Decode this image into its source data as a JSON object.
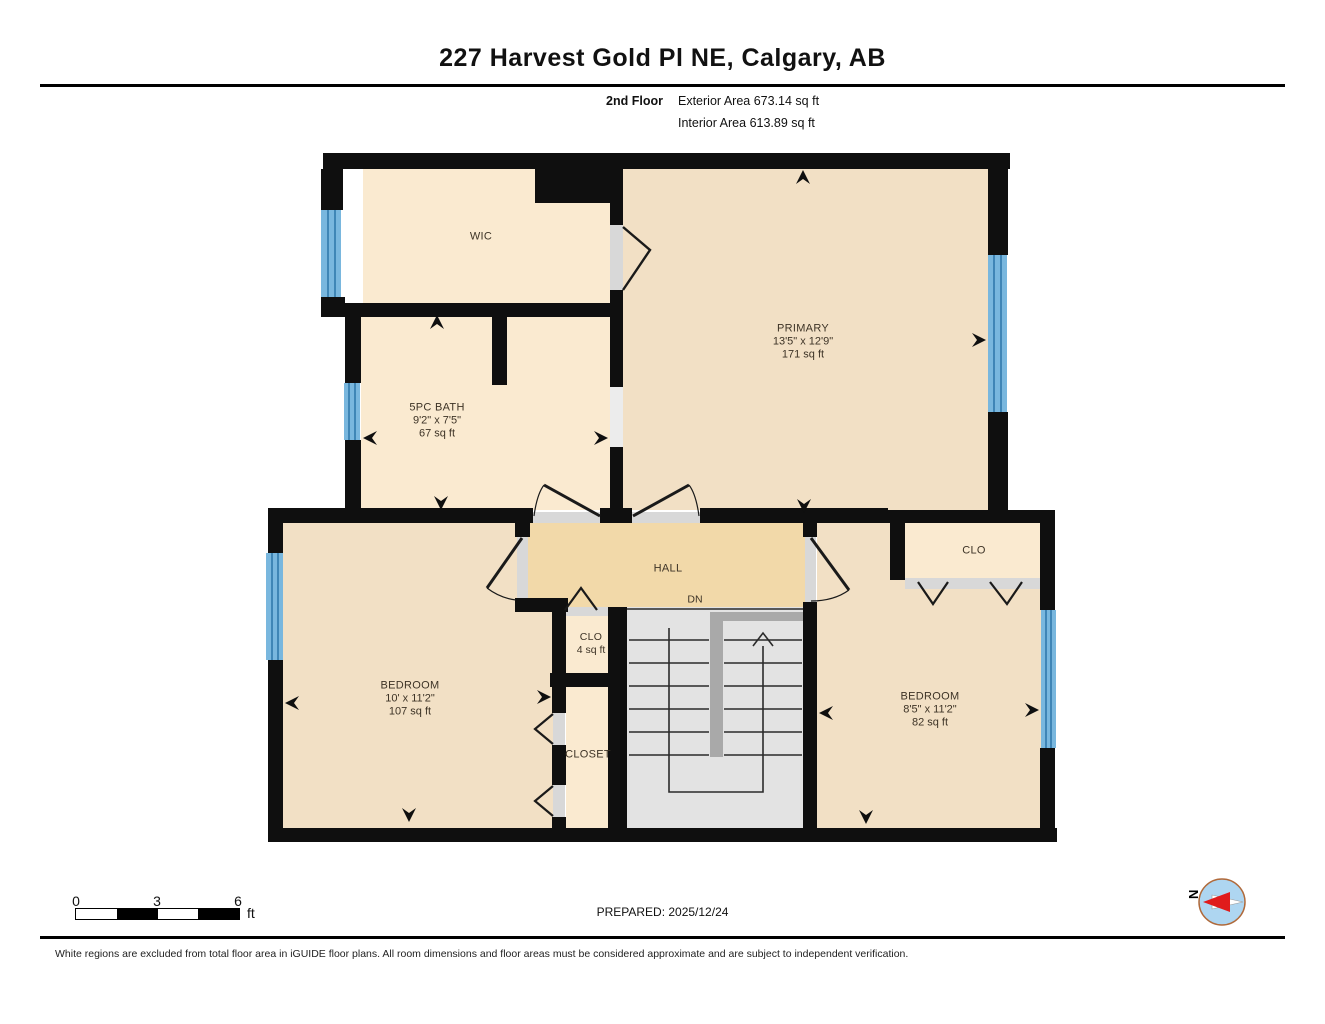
{
  "header": {
    "title": "227 Harvest Gold Pl NE, Calgary, AB",
    "floor_label": "2nd Floor",
    "exterior_area": "Exterior Area 673.14 sq ft",
    "interior_area": "Interior Area 613.89 sq ft"
  },
  "rooms": {
    "wic": {
      "name": "WIC"
    },
    "primary": {
      "name": "PRIMARY",
      "dims": "13'5\" x 12'9\"",
      "area": "171 sq ft"
    },
    "bath": {
      "name": "5PC BATH",
      "dims": "9'2\" x 7'5\"",
      "area": "67 sq ft"
    },
    "hall": {
      "name": "HALL"
    },
    "stairs": {
      "direction_label": "DN"
    },
    "clo_hall": {
      "name": "CLO",
      "area": "4 sq ft"
    },
    "bedroom_left": {
      "name": "BEDROOM",
      "dims": "10' x 11'2\"",
      "area": "107 sq ft"
    },
    "closet": {
      "name": "CLOSET"
    },
    "bedroom_right": {
      "name": "BEDROOM",
      "dims": "8'5\" x 11'2\"",
      "area": "82 sq ft"
    },
    "clo_bedroom": {
      "name": "CLO"
    }
  },
  "footer": {
    "scale": {
      "tick0": "0",
      "tick1": "3",
      "tick2": "6",
      "unit": "ft"
    },
    "prepared": "PREPARED: 2025/12/24",
    "compass_label": "N",
    "disclaimer": "White regions are excluded from total floor area in iGUIDE floor plans. All room dimensions and floor areas must be considered approximate and are subject to independent verification."
  },
  "colors": {
    "wall": "#0f0f0f",
    "room_cream": "#FAEAD0",
    "room_tan": "#F2E0C5",
    "hall_tan": "#F2D9A9",
    "stair_gray": "#E3E3E3",
    "stair_stringer": "#A9A9A9",
    "window_blue": "#79B7DE",
    "window_line": "#2C75A8",
    "threshold_gray": "#D8D8D8",
    "compass_red": "#E01B1B",
    "compass_blue": "#AED6F1"
  }
}
